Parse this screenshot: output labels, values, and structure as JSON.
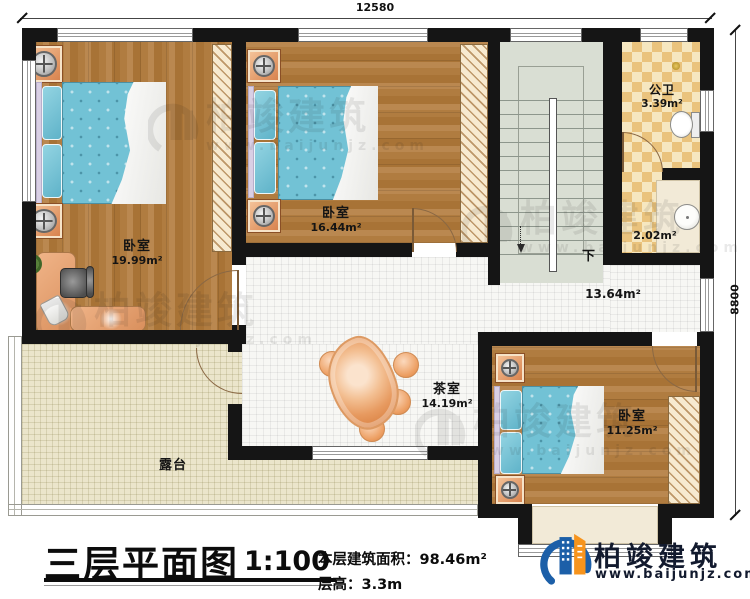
{
  "plan": {
    "dimensions": {
      "width_mm": "12580",
      "height_mm": "8800"
    },
    "rooms": {
      "bedroom1": {
        "name": "卧室",
        "area": "19.99m²"
      },
      "bedroom2": {
        "name": "卧室",
        "area": "16.44m²"
      },
      "bedroom3": {
        "name": "卧室",
        "area": "11.25m²"
      },
      "public_bath": {
        "name": "公卫",
        "area": "3.39m²"
      },
      "washroom": {
        "area": "2.02m²"
      },
      "hallway": {
        "area": "13.64m²"
      },
      "tea_room": {
        "name": "茶室",
        "area": "14.19m²"
      },
      "terrace": {
        "name": "露台"
      }
    },
    "stairs": {
      "direction_label": "下"
    }
  },
  "title_block": {
    "title": "三层平面图",
    "scale": "1:100",
    "floor_area_label": "本层建筑面积：98.46m²",
    "floor_height_label": "层高：3.3m"
  },
  "brand": {
    "name": "柏竣建筑",
    "website": "www.baijunjz.com"
  },
  "watermark": {
    "name": "柏竣建筑",
    "website": "www.baijunjz.com"
  },
  "colors": {
    "wall": "#151515",
    "wood_floor": "#b07c40",
    "bed_blue": "#72c2d5",
    "bath_tile": "#eac37d",
    "stair": "#d9ded3",
    "terrace": "#ebe5cb",
    "table_orange": "#e79a60",
    "brand_blue": "#1c5fa8",
    "brand_orange": "#f7941d"
  }
}
